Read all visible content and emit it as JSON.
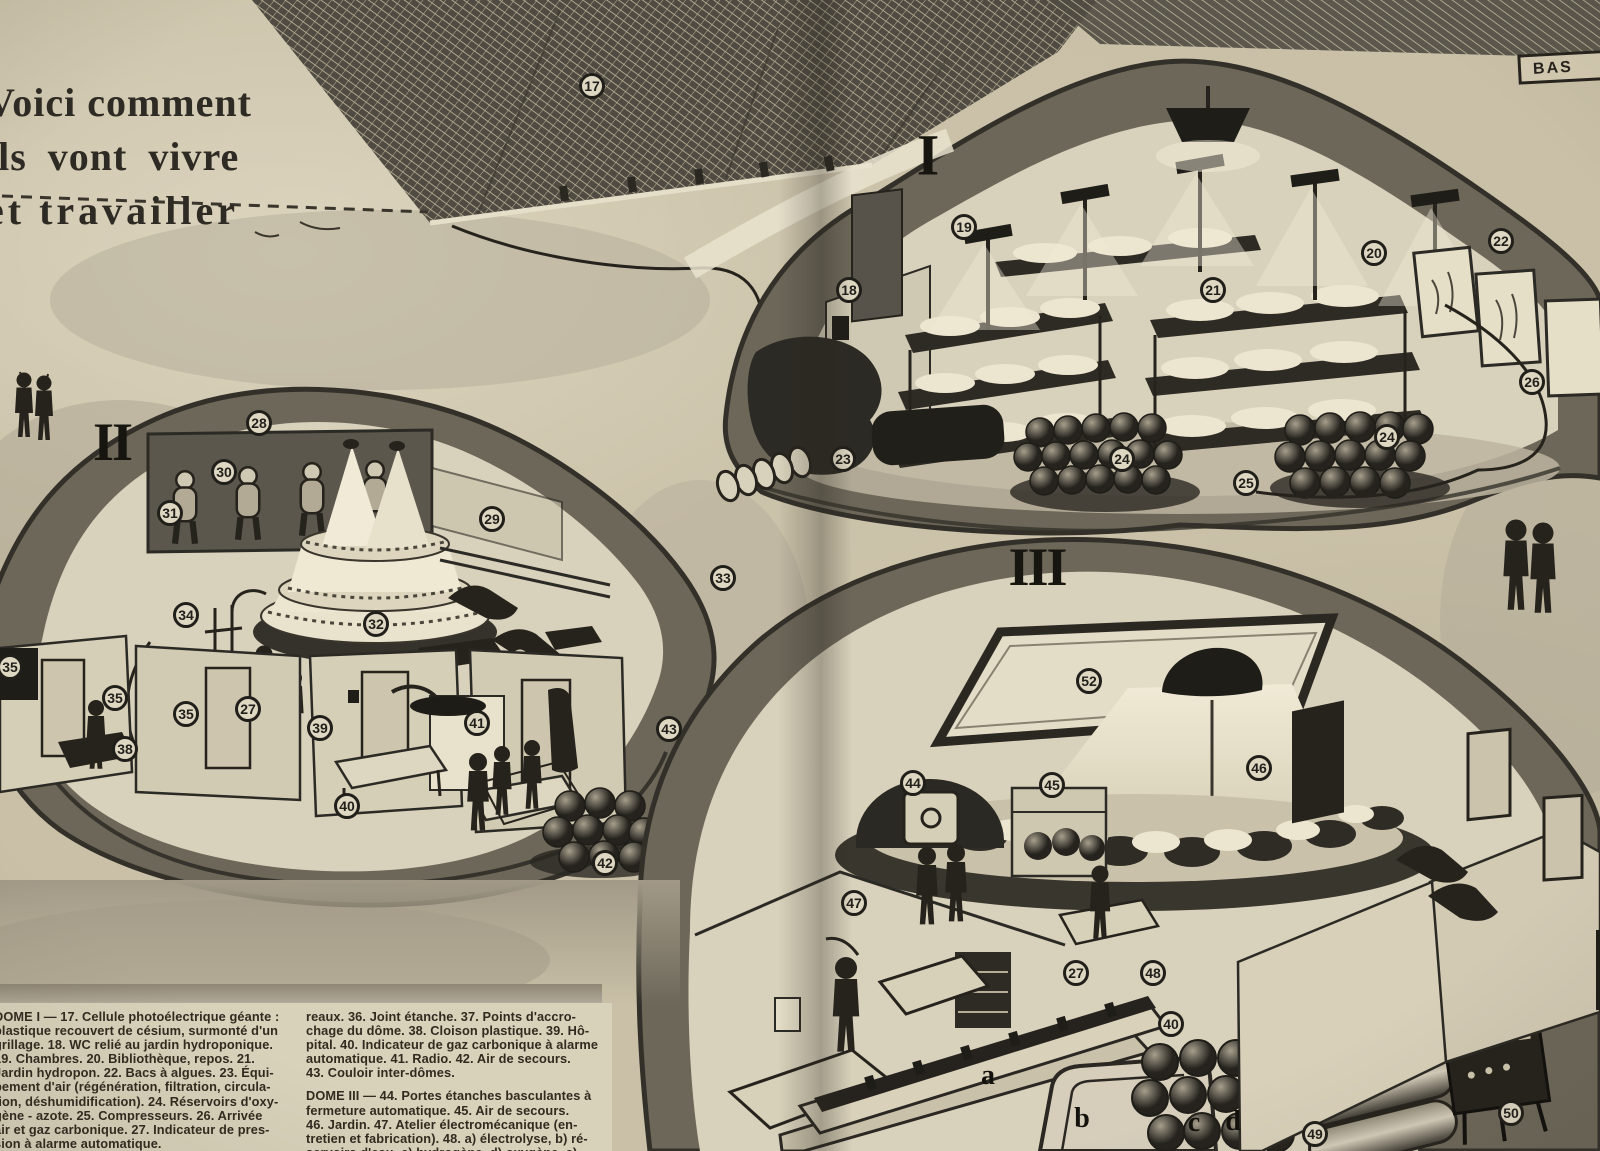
{
  "page": {
    "title_lines": [
      "Voici comment",
      "ils vont vivre",
      "et travailler"
    ],
    "corner_label": "BAS"
  },
  "dome_numerals": [
    {
      "label": "I"
    },
    {
      "label": "II"
    },
    {
      "label": "III"
    }
  ],
  "callouts": [
    {
      "label": "17"
    },
    {
      "label": "18"
    },
    {
      "label": "19"
    },
    {
      "label": "20"
    },
    {
      "label": "21"
    },
    {
      "label": "22"
    },
    {
      "label": "23"
    },
    {
      "label": "24"
    },
    {
      "label": "24"
    },
    {
      "label": "25"
    },
    {
      "label": "26"
    },
    {
      "label": "27"
    },
    {
      "label": "28"
    },
    {
      "label": "29"
    },
    {
      "label": "30"
    },
    {
      "label": "31"
    },
    {
      "label": "32"
    },
    {
      "label": "33"
    },
    {
      "label": "34"
    },
    {
      "label": "35"
    },
    {
      "label": "35"
    },
    {
      "label": "35"
    },
    {
      "label": "38"
    },
    {
      "label": "39"
    },
    {
      "label": "40"
    },
    {
      "label": "41"
    },
    {
      "label": "42"
    },
    {
      "label": "43"
    },
    {
      "label": "44"
    },
    {
      "label": "45"
    },
    {
      "label": "46"
    },
    {
      "label": "47"
    },
    {
      "label": "27"
    },
    {
      "label": "48"
    },
    {
      "label": "40"
    },
    {
      "label": "49"
    },
    {
      "label": "50"
    },
    {
      "label": "52"
    }
  ],
  "letter_labels": [
    {
      "label": "a"
    },
    {
      "label": "b"
    },
    {
      "label": "c"
    },
    {
      "label": "d"
    }
  ],
  "captions": {
    "block1_lines": [
      "DOME I — 17. Cellule photoélectrique géante :",
      "plastique recouvert de césium, surmonté d'un",
      "grillage. 18. WC relié au jardin hydroponique.",
      "19. Chambres. 20. Bibliothèque, repos. 21.",
      "Jardin hydropon. 22. Bacs à algues. 23. Équi-",
      "pement d'air (régénération, filtration, circula-",
      "tion, déshumidification). 24. Réservoirs d'oxy-",
      "gène - azote. 25. Compresseurs. 26. Arrivée",
      "air et gaz carbonique. 27. Indicateur de pres-",
      "sion à alarme automatique."
    ],
    "block2_lines": [
      "reaux. 36. Joint étanche. 37. Points d'accro-",
      "chage du dôme. 38. Cloison plastique. 39. Hô-",
      "pital. 40. Indicateur de gaz carbonique à alarme",
      "automatique. 41. Radio. 42. Air de secours.",
      "43. Couloir inter-dômes."
    ],
    "block3_lines": [
      "DOME III — 44. Portes étanches basculantes à",
      "fermeture automatique. 45. Air de secours.",
      "46. Jardin. 47. Atelier électromécanique (en-",
      "tretien et fabrication). 48. a) électrolyse, b) ré-",
      "servoirs d'eau, c) hydrogène, d) oxygène, e)"
    ]
  },
  "colors": {
    "paper": "#c9c0a7",
    "caption_paper": "#d9d2bb",
    "ink": "#26231d",
    "rock": "#6c6759",
    "dome_interior": "#d8d1bb"
  }
}
